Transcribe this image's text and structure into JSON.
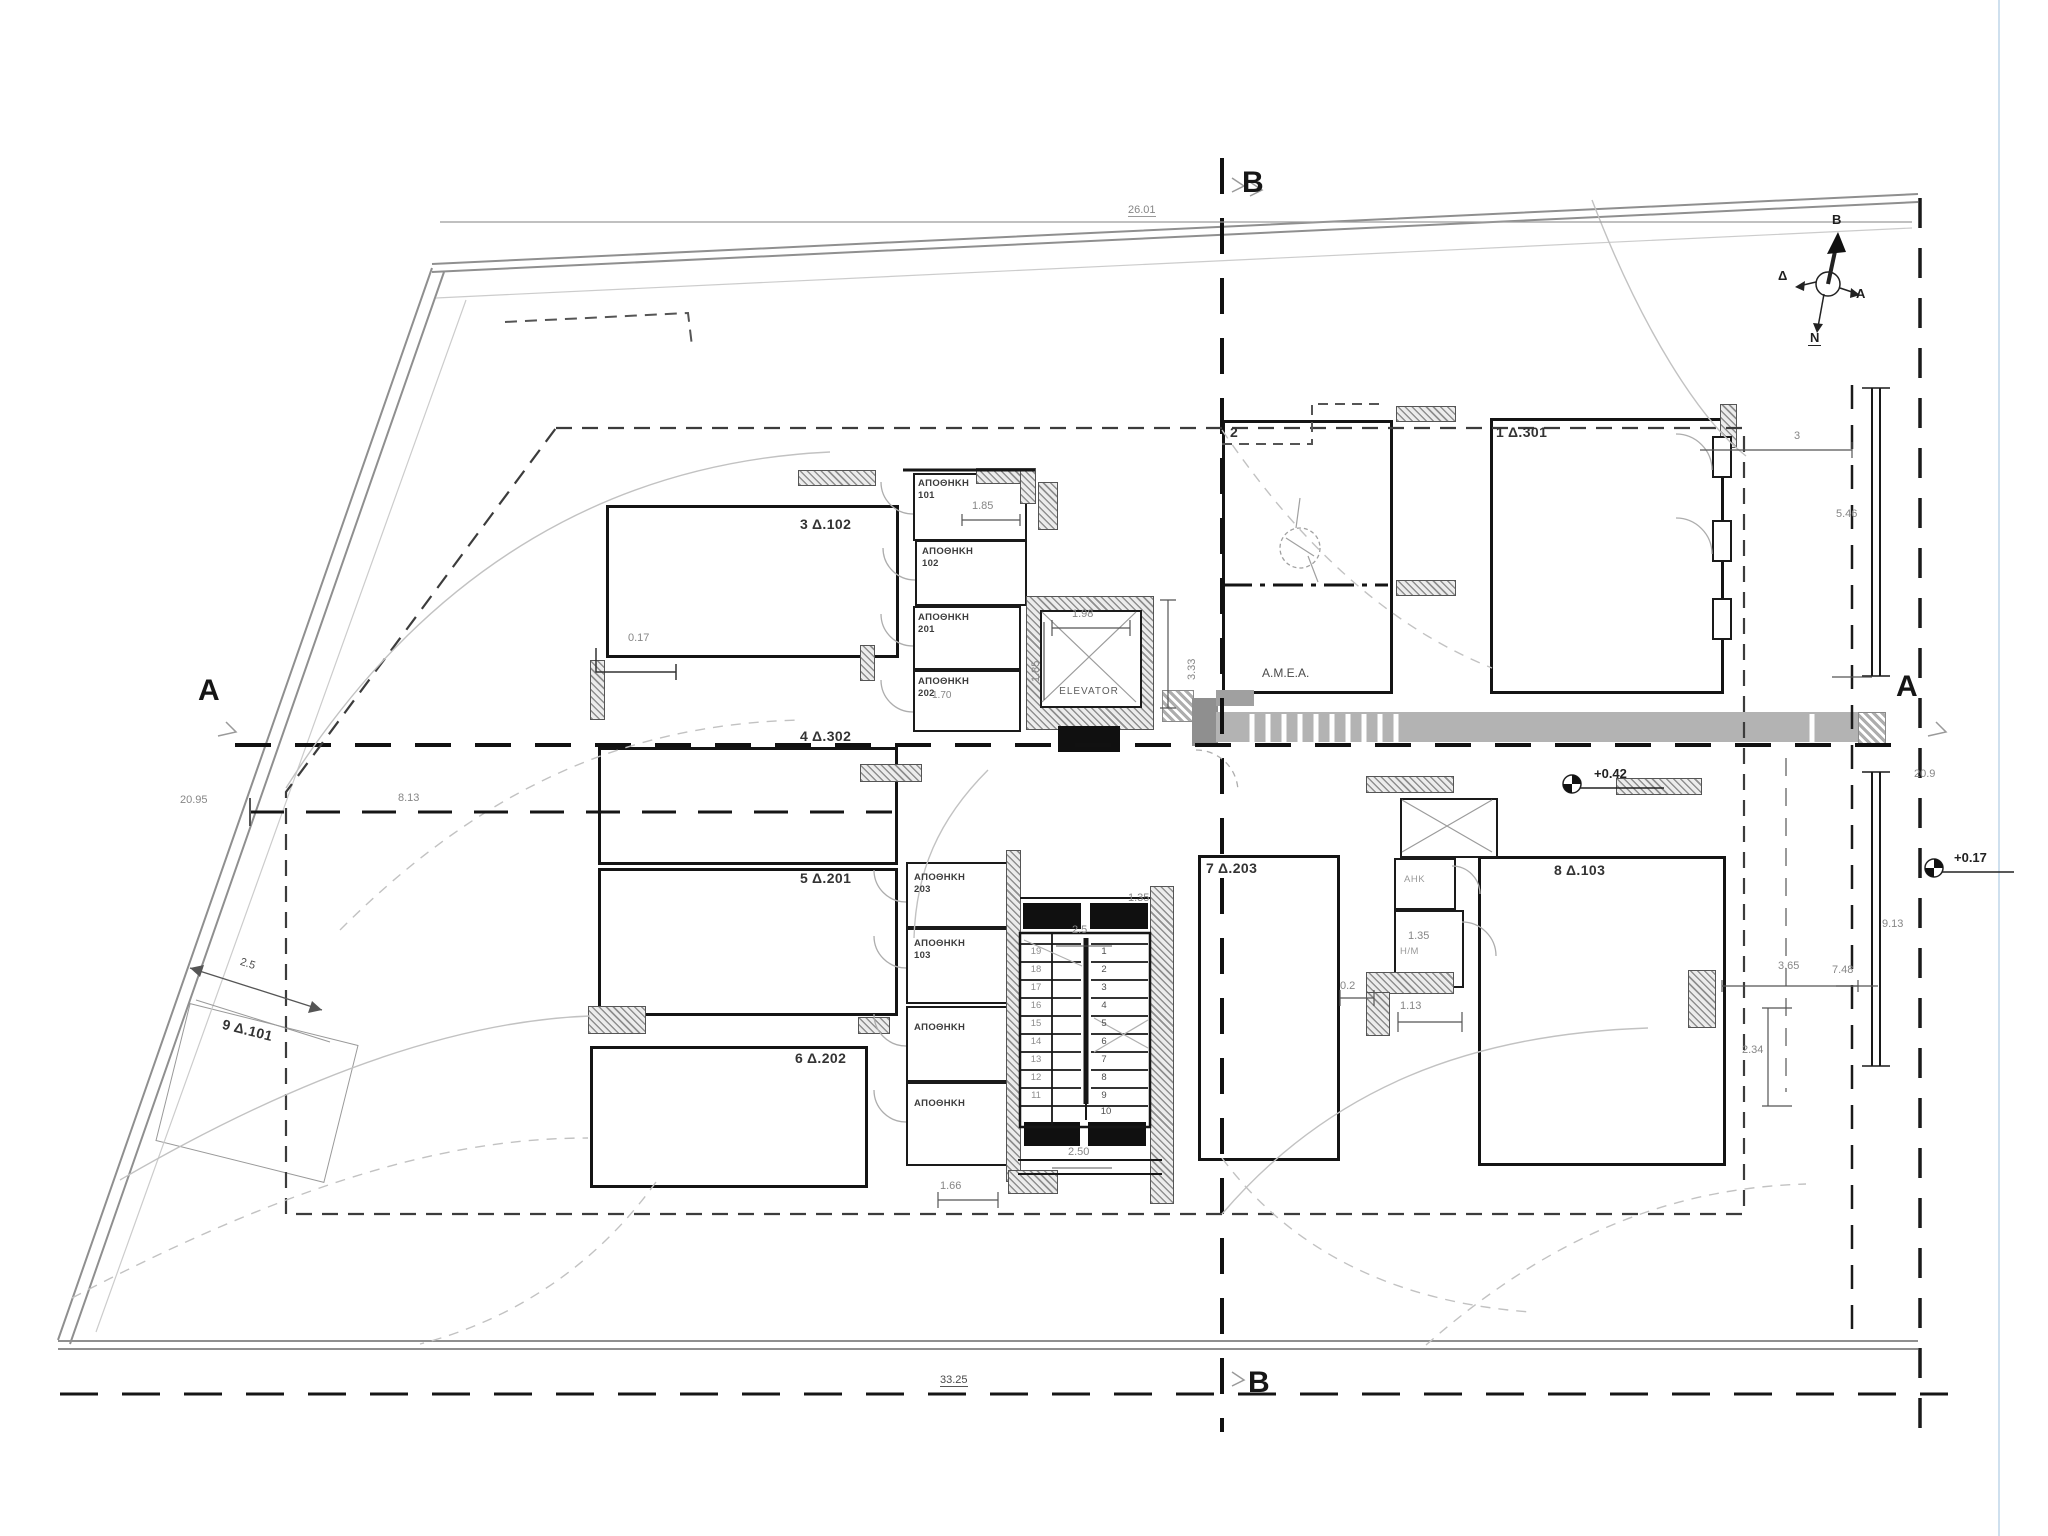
{
  "plan": {
    "section_markers": {
      "top": "B",
      "bottom": "B",
      "left": "A",
      "right": "A"
    },
    "compass": {
      "north": "B",
      "south": "N",
      "east": "A",
      "west": "Δ"
    },
    "elevator_label": "ELEVATOR",
    "amea_label": "Α.Μ.Ε.Α.",
    "parking_spaces": [
      {
        "id": "p3",
        "label": "3 Δ.102"
      },
      {
        "id": "p4",
        "label": "4 Δ.302"
      },
      {
        "id": "p5",
        "label": "5 Δ.201"
      },
      {
        "id": "p6",
        "label": "6 Δ.202"
      },
      {
        "id": "p9",
        "label": "9 Δ.101"
      },
      {
        "id": "p2",
        "label": "2"
      },
      {
        "id": "p1",
        "label": "1 Δ.301"
      },
      {
        "id": "p7",
        "label": "7 Δ.203"
      },
      {
        "id": "p8",
        "label": "8 Δ.103"
      }
    ],
    "storage_rooms": [
      {
        "name": "ΑΠΟΘΗΚΗ",
        "num": "101"
      },
      {
        "name": "ΑΠΟΘΗΚΗ",
        "num": "102"
      },
      {
        "name": "ΑΠΟΘΗΚΗ",
        "num": "201"
      },
      {
        "name": "ΑΠΟΘΗΚΗ",
        "num": "202"
      },
      {
        "name": "ΑΠΟΘΗΚΗ",
        "num": "203"
      },
      {
        "name": "ΑΠΟΘΗΚΗ",
        "num": "103"
      },
      {
        "name": "ΑΠΟΘΗΚΗ",
        "num": ""
      },
      {
        "name": "ΑΠΟΘΗΚΗ",
        "num": ""
      }
    ],
    "utility_rooms": [
      {
        "label": "ΑΗΚ"
      },
      {
        "label": "Η/Μ"
      }
    ],
    "levels": [
      {
        "label": "+0.42"
      },
      {
        "label": "+0.17"
      }
    ],
    "stairs": {
      "left": [
        "19",
        "18",
        "17",
        "16",
        "15",
        "14",
        "13",
        "12",
        "11"
      ],
      "right": [
        "1",
        "2",
        "3",
        "4",
        "5",
        "6",
        "7",
        "8",
        "9",
        "10"
      ]
    },
    "dimensions": {
      "top_width": "26.01",
      "bottom_width": "33.25",
      "left_a": "20.95",
      "left_b": "8.13",
      "plot_side": "2.5",
      "right_top": "3",
      "right_upper": "5.46",
      "right_mid": "20.9",
      "right_lower": "9.13",
      "right_small": "7.48",
      "dim_234": "2.34",
      "dim_365": "3.65",
      "st101": "1.85",
      "elev_w": "1.98",
      "elev_h": "1.85",
      "elev_side": "3.33",
      "stair_top": "2.5",
      "stair_top2": "1.35",
      "stair_bottom": "2.50",
      "stor_bottom": "1.66",
      "util_135": "1.35",
      "util_113": "1.13",
      "util_02": "0.2",
      "corner_017": "0.17",
      "lobby_170": "1.70"
    }
  }
}
